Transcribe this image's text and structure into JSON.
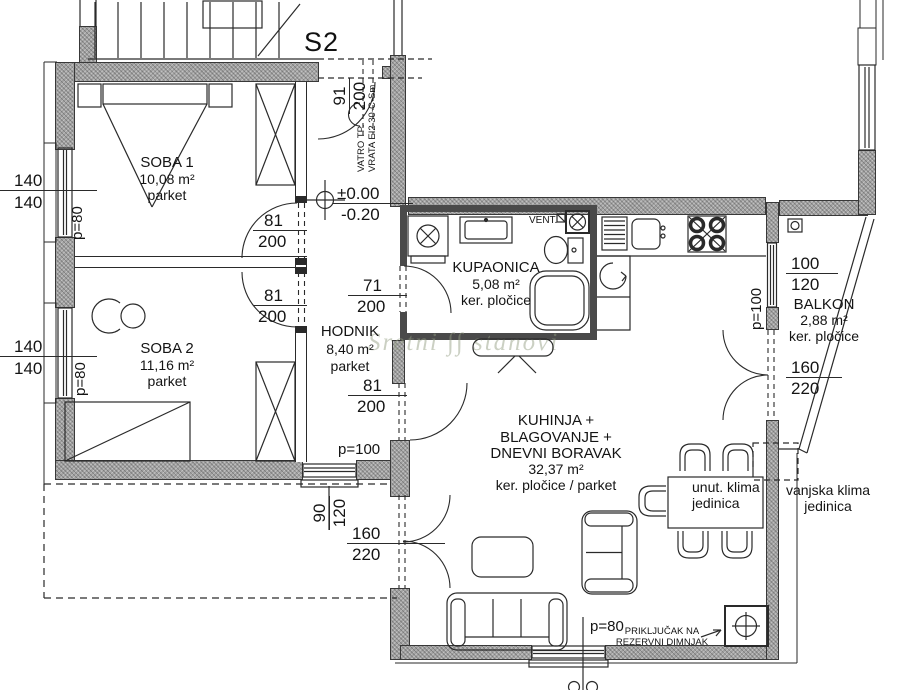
{
  "unit_label": "S2",
  "watermark": {
    "word1": "Sretni",
    "word2": "stanovi"
  },
  "level_marker": {
    "above": "±0.00",
    "below": "-0.20"
  },
  "rooms": {
    "soba1": {
      "name": "SOBA 1",
      "area": "10,08 m²",
      "floor": "parket"
    },
    "soba2": {
      "name": "SOBA 2",
      "area": "11,16 m²",
      "floor": "parket"
    },
    "hodnik": {
      "name": "HODNIK",
      "area": "8,40 m²",
      "floor": "parket"
    },
    "kupaonica": {
      "name": "KUPAONICA",
      "area": "5,08 m²",
      "floor": "ker. pločice"
    },
    "living": {
      "line1": "KUHINJA +",
      "line2": "BLAGOVANJE +",
      "line3": "DNEVNI BORAVAK",
      "area": "32,37 m²",
      "floor": "ker. pločice / parket"
    },
    "balkon": {
      "name": "BALKON",
      "area": "2,88 m²",
      "floor": "ker. pločice"
    }
  },
  "annotations": {
    "vent": "VENT.",
    "fire_door_line1": "VATRO TP.",
    "fire_door_line2": "VRATA EI2 30-C-Sm",
    "indoor_ac_line1": "unut. klima",
    "indoor_ac_line2": "jedinica",
    "outdoor_ac_line1": "vanjska klima",
    "outdoor_ac_line2": "jedinica",
    "chimney_line1": "PRIKLJUČAK NA",
    "chimney_line2": "REZERVNI DIMNJAK"
  },
  "dimensions": {
    "window_soba1": {
      "top": "140",
      "bottom": "140"
    },
    "window_soba2": {
      "top": "140",
      "bottom": "140"
    },
    "parapet_soba1": "p=80",
    "parapet_soba2": "p=80",
    "entry_door": {
      "top": "91",
      "bottom": "200"
    },
    "door_soba1": {
      "top": "81",
      "bottom": "200"
    },
    "door_soba2": {
      "top": "81",
      "bottom": "200"
    },
    "door_kupaonica": {
      "top": "71",
      "bottom": "200"
    },
    "door_living": {
      "top": "81",
      "bottom": "200"
    },
    "window_balkon": {
      "top": "100",
      "bottom": "120"
    },
    "parapet_balkon": "p=100",
    "door_balkon": {
      "top": "160",
      "bottom": "220"
    },
    "window_hodnik": {
      "top": "90",
      "bottom": "120"
    },
    "parapet_hodnik": "p=100",
    "door_terrace": {
      "top": "160",
      "bottom": "220"
    },
    "parapet_bottom": "p=80"
  }
}
